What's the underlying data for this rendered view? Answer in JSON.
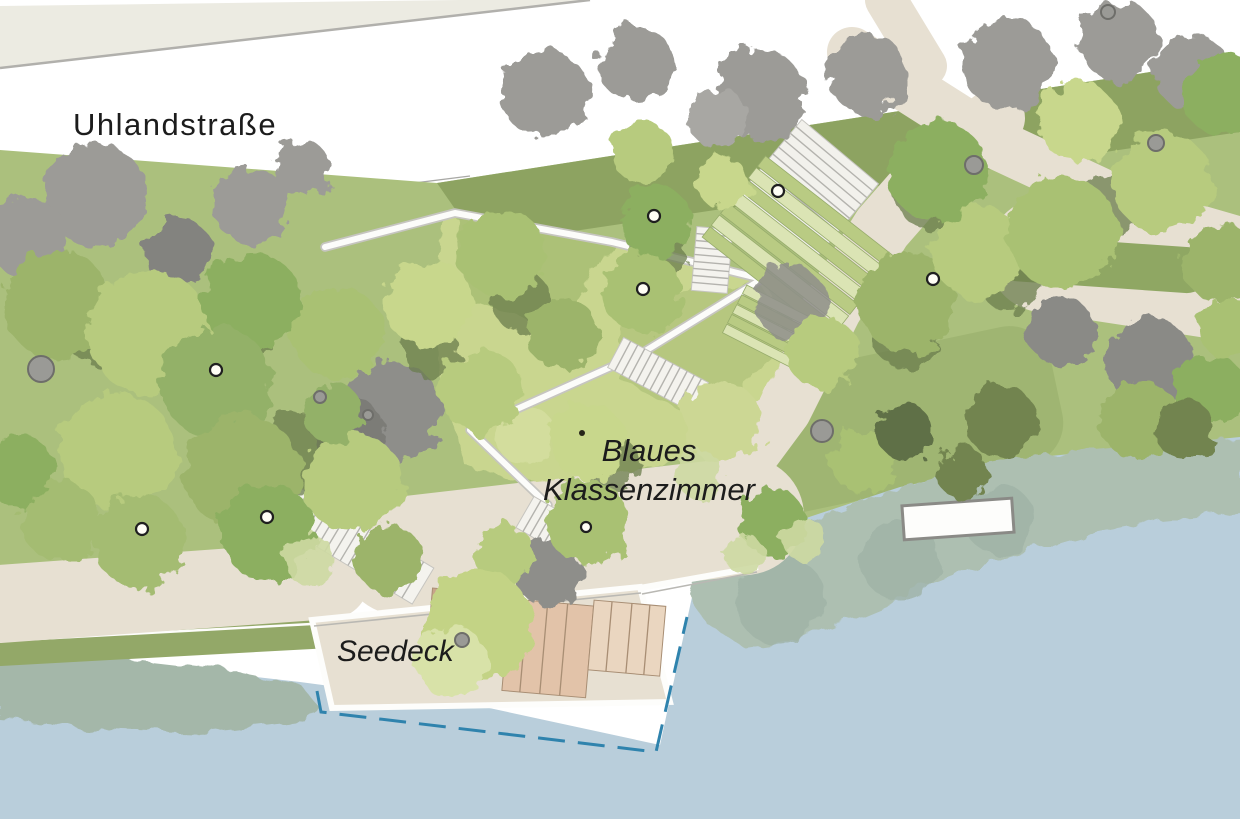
{
  "labels": {
    "street_name": "Uhlandstraße",
    "blue_classroom_line1": "Blaues",
    "blue_classroom_line2": "Klassenzimmer",
    "lake_deck": "Seedeck"
  },
  "palette": {
    "water": "#b9cedb",
    "reeds_right": "#adbfb1",
    "reeds_left": "#a4b7a9",
    "lawn": "#abc07d",
    "lawn_dark_band": "#8aa05e",
    "classroom_lawn": "#c9d68f",
    "right_lawn": "#9fb572",
    "island_green": "#8fa763",
    "bank_green": "#93a868",
    "path_tan": "#e7e0d2",
    "sidewalk": "#ecebe2",
    "street": "#ffffff",
    "deck_wood": "#e2c3a9",
    "boundary_dash": "#2f83ad",
    "existing_tree_gray": "#9c9b97",
    "label_text": "#1c1c1c"
  },
  "features": [
    {
      "name": "uhlandstrasse-street",
      "kind": "street"
    },
    {
      "name": "park-tree-canopies",
      "kind": "vegetation"
    },
    {
      "name": "blaues-klassenzimmer-terraces",
      "kind": "seating-steps"
    },
    {
      "name": "ramp-zigzag-path",
      "kind": "path"
    },
    {
      "name": "stair-flights",
      "kind": "stairs"
    },
    {
      "name": "seedeck-platform",
      "kind": "deck"
    },
    {
      "name": "water-boundary-dashed",
      "kind": "dashed-line"
    },
    {
      "name": "reed-beds",
      "kind": "vegetation"
    },
    {
      "name": "lake-water",
      "kind": "water"
    },
    {
      "name": "floating-pier",
      "kind": "platform"
    }
  ]
}
